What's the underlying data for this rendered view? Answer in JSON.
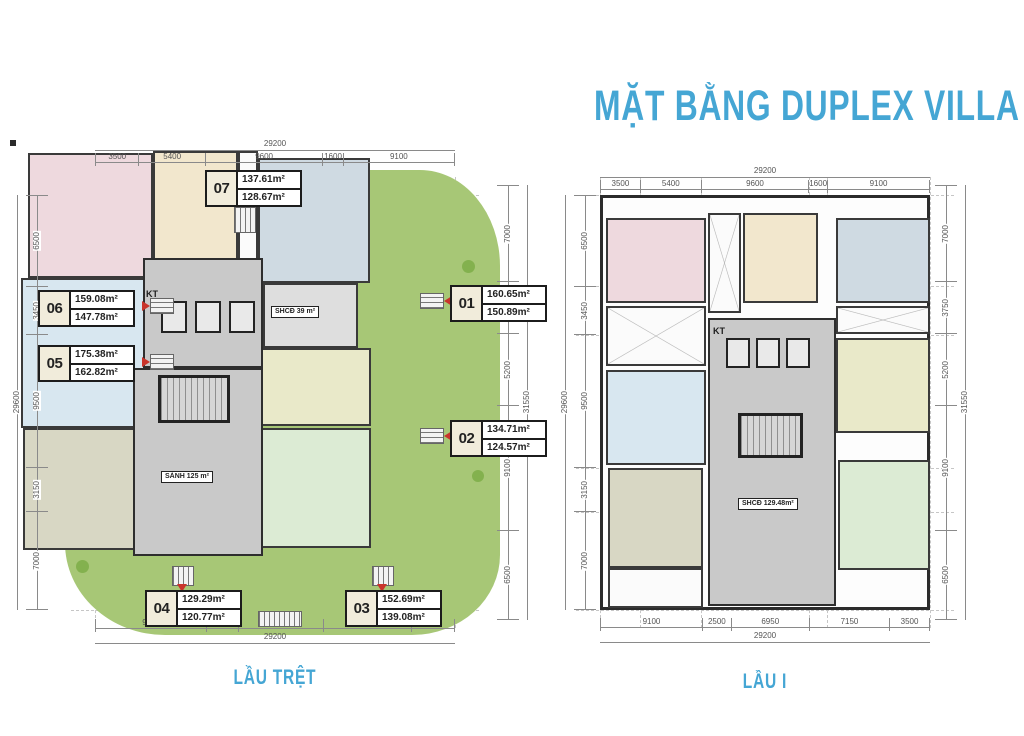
{
  "title": "MẶT BẰNG DUPLEX VILLA",
  "colors": {
    "accent": "#45a6d4",
    "entry_red": "#c9342b",
    "site_green": "#a7c776",
    "wall": "#2b2b2b"
  },
  "plans": [
    {
      "name": "LẦU TRỆT",
      "dims": {
        "top": {
          "overall": "29200",
          "segments": [
            "3500",
            "5400",
            "9600",
            "1600",
            "9100"
          ]
        },
        "bottom": {
          "overall": "29200",
          "segments": [
            "9100",
            "2500",
            "6950",
            "7150",
            "3500"
          ]
        },
        "left": {
          "overall": "29600",
          "segments": [
            "6500",
            "3450",
            "9500",
            "3150",
            "7000"
          ]
        },
        "right": {
          "overall": "31550",
          "segments": [
            "7000",
            "3750",
            "5200",
            "9100",
            "6500"
          ]
        }
      },
      "units": {
        "u07": {
          "no": "07",
          "area_upper": "137.61m²",
          "area_lower": "128.67m²"
        },
        "u06": {
          "no": "06",
          "area_upper": "159.08m²",
          "area_lower": "147.78m²"
        },
        "u05": {
          "no": "05",
          "area_upper": "175.38m²",
          "area_lower": "162.82m²"
        },
        "u01": {
          "no": "01",
          "area_upper": "160.65m²",
          "area_lower": "150.89m²"
        },
        "u02": {
          "no": "02",
          "area_upper": "134.71m²",
          "area_lower": "124.57m²"
        },
        "u04": {
          "no": "04",
          "area_upper": "129.29m²",
          "area_lower": "120.77m²"
        },
        "u03": {
          "no": "03",
          "area_upper": "152.69m²",
          "area_lower": "139.08m²"
        }
      },
      "core": {
        "kt": "KT",
        "shcd": "SHCĐ 39 m²",
        "sanh": "SẢNH 125 m²"
      }
    },
    {
      "name": "LẦU I",
      "dims": {
        "top": {
          "overall": "29200",
          "segments": [
            "3500",
            "5400",
            "9600",
            "1600",
            "9100"
          ]
        },
        "bottom": {
          "overall": "29200",
          "segments": [
            "9100",
            "2500",
            "6950",
            "7150",
            "3500"
          ]
        },
        "left": {
          "overall": "29600",
          "segments": [
            "6500",
            "3450",
            "9500",
            "3150",
            "7000"
          ]
        },
        "right": {
          "overall": "31550",
          "segments": [
            "7000",
            "3750",
            "5200",
            "9100",
            "6500"
          ]
        }
      },
      "core": {
        "kt": "KT",
        "shcd": "SHCĐ 129.48m²"
      }
    }
  ]
}
